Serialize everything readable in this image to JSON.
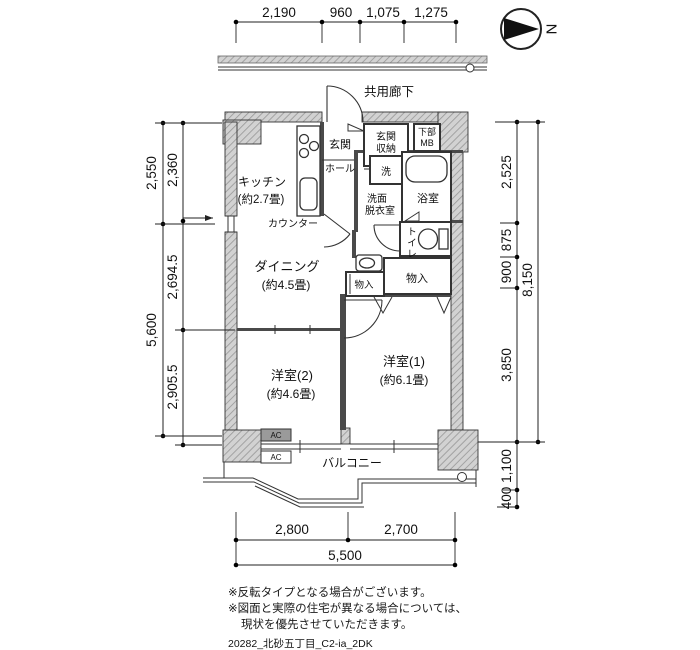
{
  "compass": {
    "label": "N"
  },
  "corridor": {
    "label": "共用廊下"
  },
  "rooms": {
    "genkan": "玄関",
    "genkan_storage": [
      "玄関",
      "収納"
    ],
    "mb": [
      "下部",
      "MB"
    ],
    "kitchen": [
      "キッチン",
      "(約2.7畳)"
    ],
    "hall": "ホール",
    "washer": "洗",
    "washroom": [
      "洗面",
      "脱衣室"
    ],
    "bath": "浴室",
    "toilet": [
      "ト",
      "イ",
      "レ"
    ],
    "counter": "カウンター",
    "dining": [
      "ダイニング",
      "(約4.5畳)"
    ],
    "storage_small": "物入",
    "storage_large": "物入",
    "bedroom2": [
      "洋室(2)",
      "(約4.6畳)"
    ],
    "bedroom1": [
      "洋室(1)",
      "(約6.1畳)"
    ],
    "balcony": "バルコニー",
    "ac_upper": "AC",
    "ac_lower": "AC"
  },
  "dimensions": {
    "top": [
      "2,190",
      "960",
      "1,075",
      "1,275"
    ],
    "left_outer": [
      "2,550",
      "5,600"
    ],
    "left_inner": [
      "2,360",
      "2,694.5",
      "2,905.5"
    ],
    "right_inner": [
      "2,525",
      "875",
      "900",
      "3,850",
      "1,100",
      "400"
    ],
    "right_outer": "8,150",
    "bottom_upper": [
      "2,800",
      "2,700"
    ],
    "bottom_total": "5,500"
  },
  "notes": {
    "line1": "※反転タイプとなる場合がございます。",
    "line2": "※図面と実際の住宅が異なる場合については、",
    "line3": "現状を優先させていただきます。",
    "file_id": "20282_北砂五丁目_C2-ia_2DK"
  }
}
